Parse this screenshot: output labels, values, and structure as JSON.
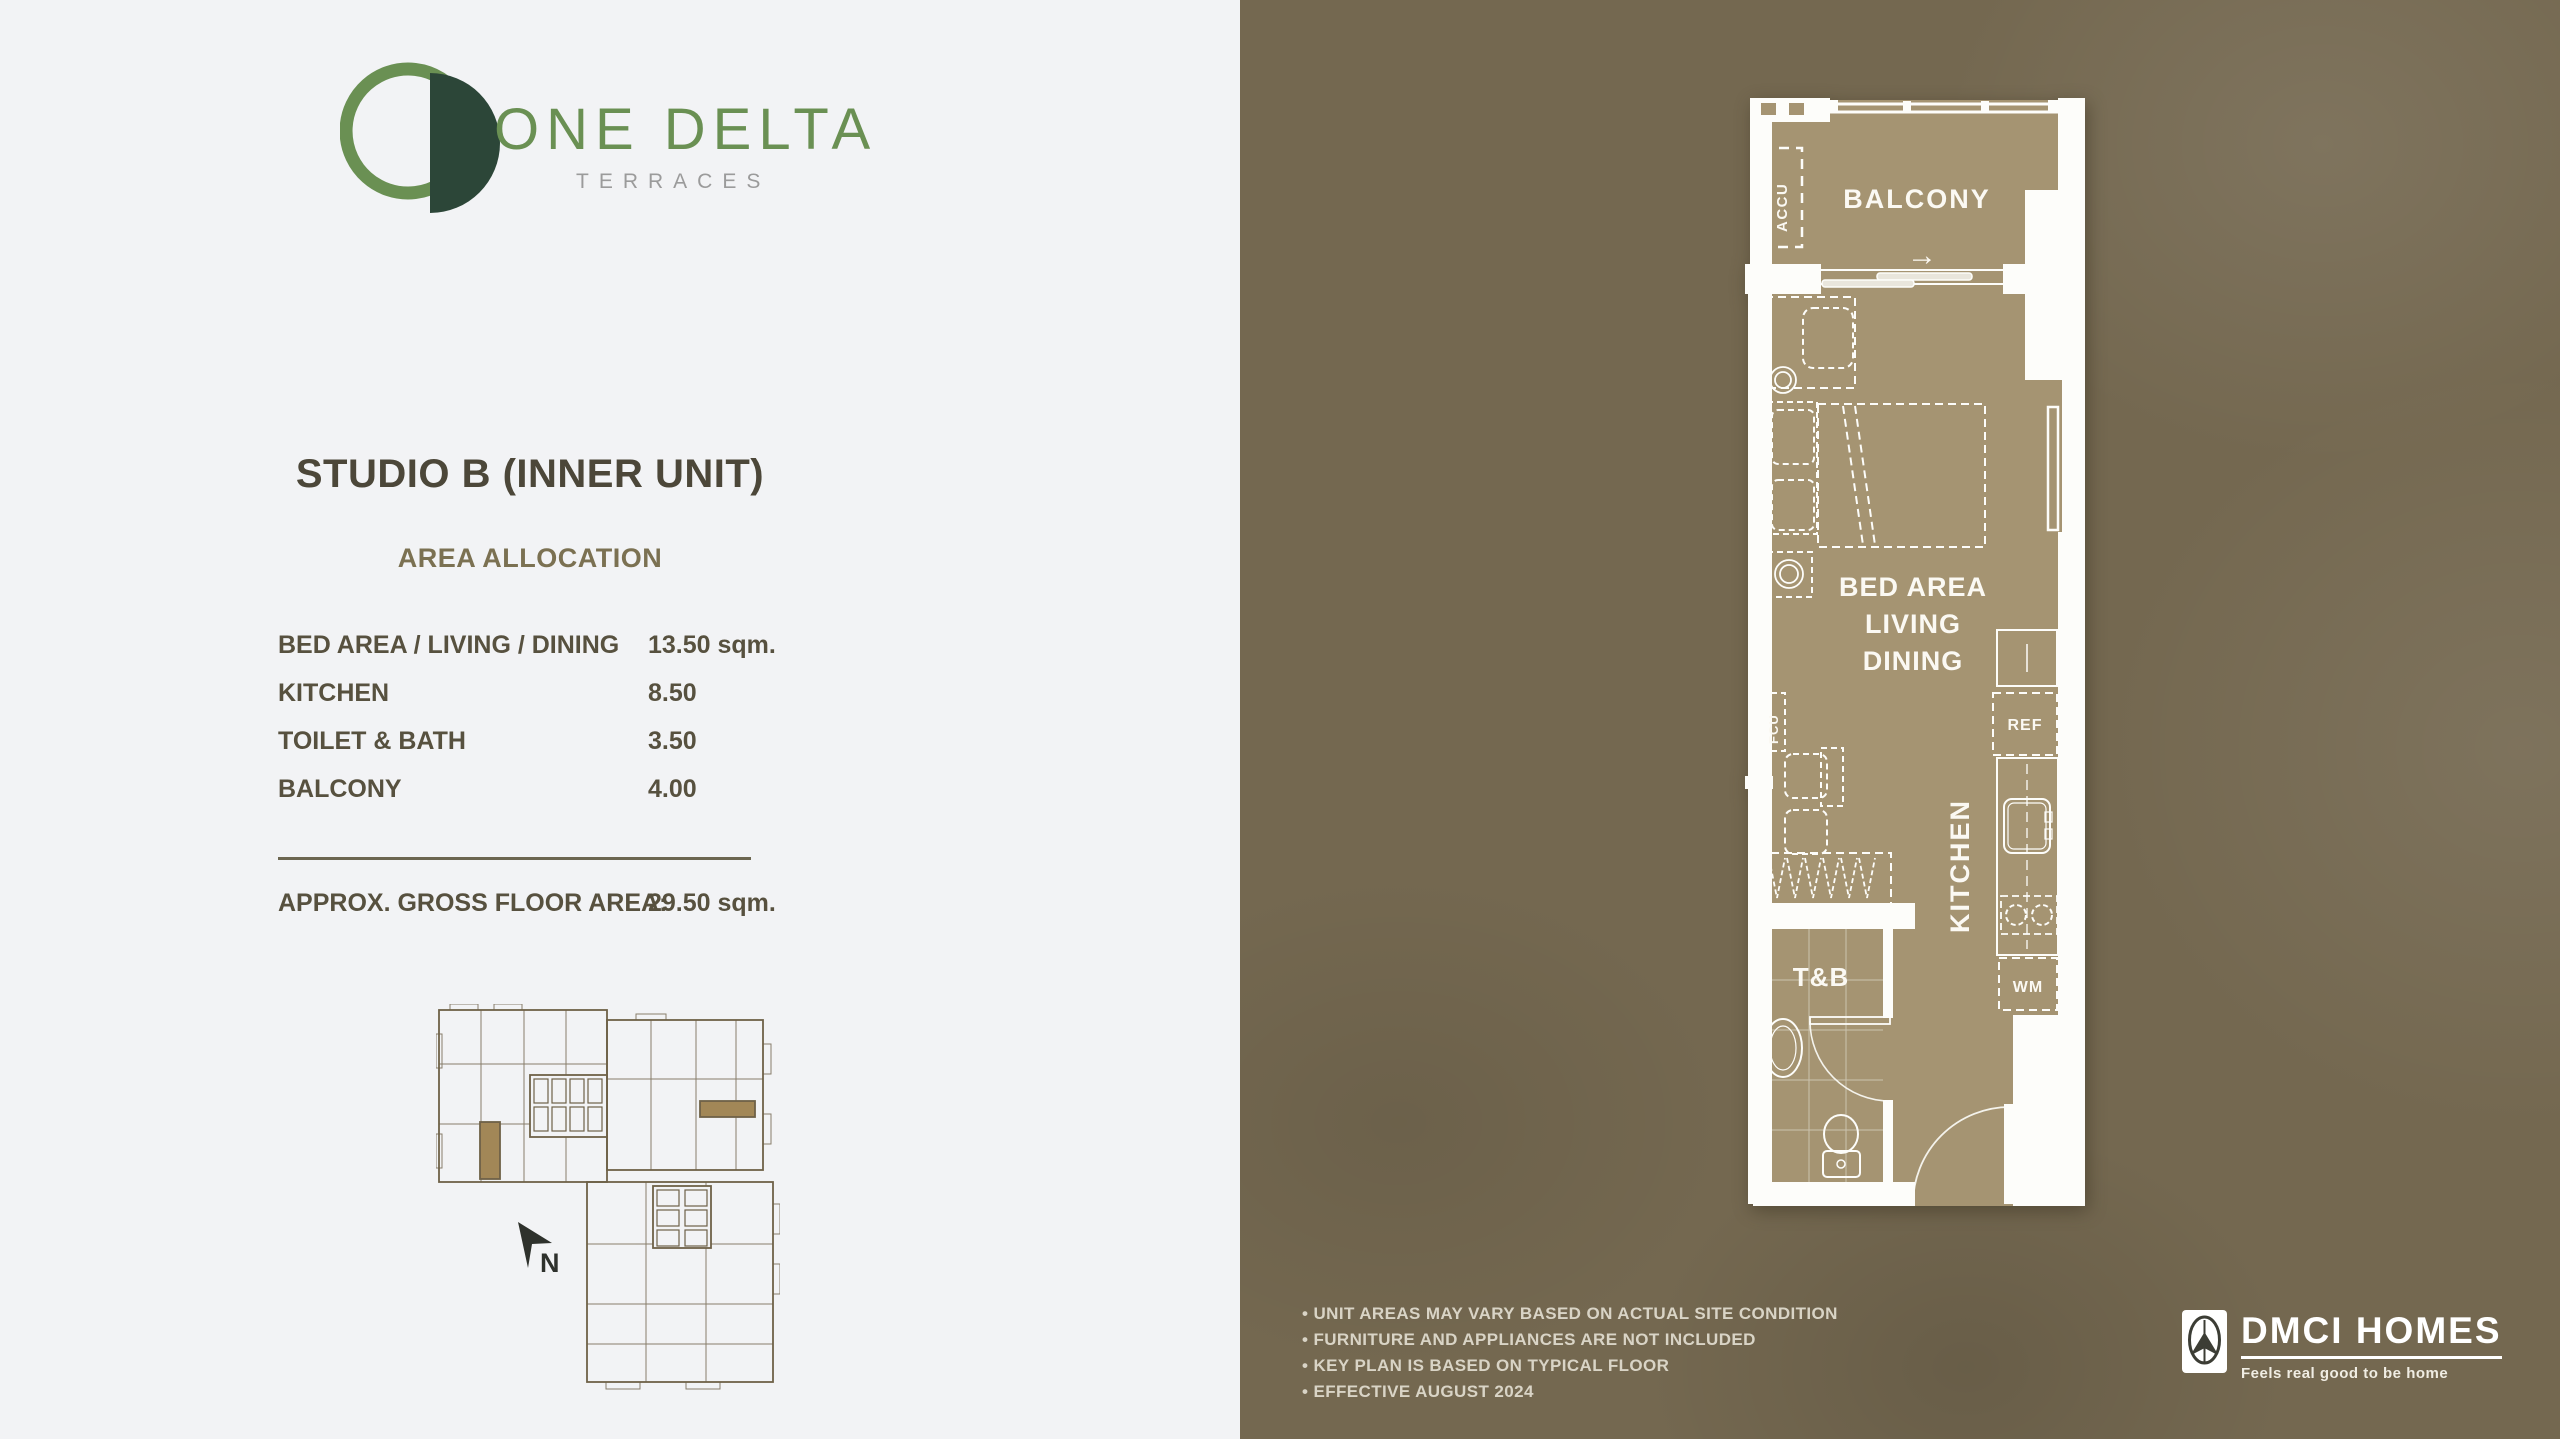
{
  "brand": {
    "name": "ONE DELTA",
    "subname": "TERRACES"
  },
  "unit": {
    "title": "STUDIO B (INNER UNIT)",
    "section": "AREA ALLOCATION",
    "areas": [
      {
        "label": "BED AREA / LIVING / DINING",
        "value": "13.50 sqm."
      },
      {
        "label": "KITCHEN",
        "value": "8.50"
      },
      {
        "label": "TOILET & BATH",
        "value": "3.50"
      },
      {
        "label": "BALCONY",
        "value": "4.00"
      }
    ],
    "total_label": "APPROX. GROSS FLOOR AREA:",
    "total_value": "29.50 sqm."
  },
  "key_plan": {
    "north": "N"
  },
  "plan_labels": {
    "balcony": "BALCONY",
    "accu": "ACCU",
    "entry_arrow": "→",
    "bed_line1": "BED AREA",
    "bed_line2": "LIVING",
    "bed_line3": "DINING",
    "fcu": "FCU",
    "kitchen": "KITCHEN",
    "ref": "REF",
    "wm": "WM",
    "tb": "T&B"
  },
  "notes": [
    "• UNIT AREAS MAY VARY BASED ON ACTUAL SITE CONDITION",
    "• FURNITURE AND APPLIANCES ARE NOT INCLUDED",
    "• KEY PLAN IS BASED ON TYPICAL FLOOR",
    "• EFFECTIVE AUGUST 2024"
  ],
  "developer": {
    "name": "DMCI HOMES",
    "tagline": "Feels real good to be home"
  },
  "colors": {
    "accent_green": "#6a9053",
    "logo_dark": "#2c4638",
    "panel_brown": "#746850",
    "plan_interior": "#a59472",
    "wall_white": "#fdfdfa",
    "text_dark": "#4c4739",
    "text_olive": "#7b7152",
    "key_plan_line": "#6e6148",
    "key_plan_highlight": "#a28757"
  }
}
